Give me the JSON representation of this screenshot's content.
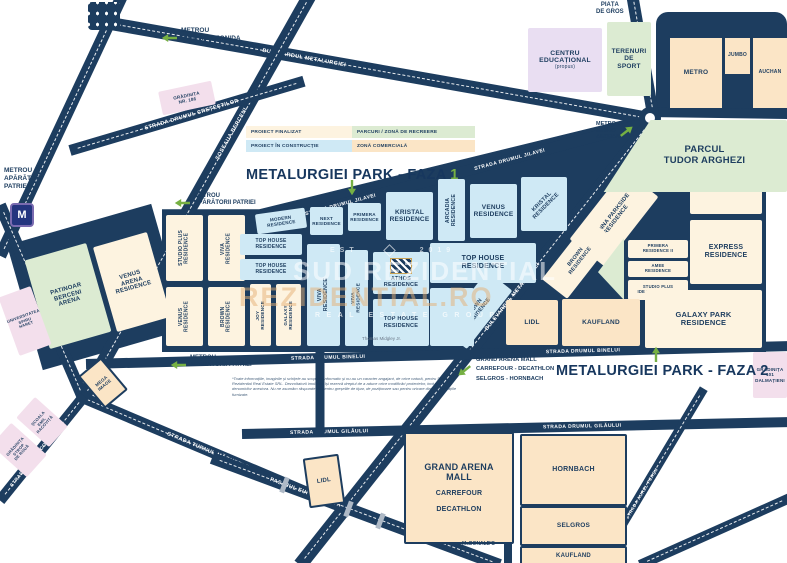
{
  "titles": {
    "faza1_prefix": "METALURGIEI PARK - FAZA ",
    "faza1_number": "1",
    "faza2": "METALURGIEI PARK - FAZA 2"
  },
  "legend": [
    {
      "label": "PROIECT FINALIZAT",
      "color": "#fdf3e0"
    },
    {
      "label": "PROIECT ÎN CONSTRUCȚIE",
      "color": "#cfe9f5"
    },
    {
      "label": "PARCURI / ZONĂ DE RECREERE",
      "color": "#dcebd2"
    },
    {
      "label": "ZONĂ COMERCIALĂ",
      "color": "#fbe5c6"
    }
  ],
  "roads": [
    {
      "label": "BULEVARDUL METALURGIEI"
    },
    {
      "label": "ȘOSEAUA BERCENI"
    },
    {
      "label": "STRADA DRUMUL CREȚEȘTILOR"
    },
    {
      "label": "STRADA DRUMUL JILAVEI",
      "label2": "STRADA DRUMUL JILAVEI"
    },
    {
      "label": "BULEVARDUL METALURGIEI"
    },
    {
      "label": "STRADA DRUMUL BINELUI",
      "label2": "STRADA DRUMUL BINELUI"
    },
    {
      "label": "STRADA DRUMUL GILĂULUI",
      "label2": "STRADA DRUMUL GILĂULUI"
    },
    {
      "label": "STRADA TURNUL MĂGURELE"
    },
    {
      "label": "STRADA EMIL RACOVIȚĂ"
    },
    {
      "label": "PASAJUL EUROPA UNITĂ"
    },
    {
      "label": "STRADA AUREL PERȘU"
    }
  ],
  "blocks": [
    {
      "label": "STUDIO PLUS\nRESIDENCE"
    },
    {
      "label": "VIVA\nRESIDENCE"
    },
    {
      "label": "VENUS\nRESIDENCE"
    },
    {
      "label": "BROWN\nRESIDENCE"
    },
    {
      "label": "JOY\nRESIDENCE"
    },
    {
      "label": "GALAXY\nRESIDENCE"
    },
    {
      "label": "TOP HOUSE\nRESIDENCE"
    },
    {
      "label": "TOP HOUSE\nRESIDENCE"
    },
    {
      "label": "MODERN\nRESIDENCE"
    },
    {
      "label": "NEXT\nRESIDENCE"
    },
    {
      "label": "PRIMERA\nRESIDENCE"
    },
    {
      "label": "KRISTAL\nRESIDENCE"
    },
    {
      "label": "ARCADIA\nRESIDENCE"
    },
    {
      "label": "VENUS\nRESIDENCE"
    },
    {
      "label": "KRISTAL\nRESIDENCE"
    },
    {
      "label": "TOP HOUSE\nRESIDENCE"
    },
    {
      "label": "VIVA\nRESIDENCE"
    },
    {
      "label": "VIVA\nRESIDENCE"
    },
    {
      "label": "ATHOS\nRESIDENCE"
    },
    {
      "label": "TOP HOUSE\nRESIDENCE"
    },
    {
      "label": "BROWN\nRESIDENCE"
    },
    {
      "label": ""
    },
    {
      "label": "VIENNA PARKSIDE\nRESIDENCE"
    },
    {
      "label": ""
    },
    {
      "label": "EXPRESS\nRESIDENCE"
    },
    {
      "label": "PRIMERA\nRESIDENCE II"
    },
    {
      "label": "AMEE\nRESIDENCE"
    },
    {
      "label": "STUDIO PLUS\nIDEAL RESIDENCE"
    },
    {
      "label": ""
    },
    {
      "label": "BROWN\nRESIDENCE"
    },
    {
      "label": "LIDL"
    },
    {
      "label": "KAUFLAND"
    },
    {
      "label": "GALAXY PARK\nRESIDENCE"
    },
    {
      "label": "CENTRU\nEDUCAȚIONAL",
      "sub": "(propus)"
    },
    {
      "label": "TERENURI\nDE\nSPORT"
    },
    {
      "label": "METRO"
    },
    {
      "label": "JUMBO"
    },
    {
      "label": "AUCHAN"
    },
    {
      "label": "PARCUL\nTUDOR ARGHEZI"
    },
    {
      "label": "PATINOAR\nBERCENI\nARENA"
    },
    {
      "label": "VENUS\nARENA\nRESIDENCE"
    },
    {
      "label": "GRĂDINIȚA\nNR. 186"
    },
    {
      "label": "UNIVERSITATEA\nSPIRU\nHARET"
    },
    {
      "label": "ȘCOALA\nEMIL\nRACOVIȚĂ"
    },
    {
      "label": "GRĂDINIȚA\nSTROP\nDE ROUĂ"
    },
    {
      "label": "GRĂDINIȚA\n101\nDALMAȚIENI"
    },
    {
      "label": "MEGA\nIMAGE"
    },
    {
      "label": "GRAND ARENA\nMALL",
      "sub": "CARREFOUR",
      "sub2": "DECATHLON"
    },
    {
      "label": "HORNBACH"
    },
    {
      "label": "SELGROS"
    },
    {
      "label": "KAUFLAND"
    },
    {
      "label": "LIDL"
    }
  ],
  "annotations": {
    "metrou_dimitrie": "METROU\nDIMITRIE LEONIDA",
    "metrou_aparatori_left": "METROU\nAPĂRĂTORI\nPATRIEI",
    "metro_logo": "M",
    "metrou_aparatorii_1": "METROU\nAPĂRĂTORII PATRIEI",
    "metrou_aparatorii_2": "METROU\nAPĂRĂTORII PATRIEI",
    "piata_de_gros": "PIAȚA\nDE GROS",
    "metro_jumbo_auchan": "METRO\nJUMBO\nAUCHAN",
    "grand_arena_pointer": "GRAND ARENA MALL\nCARREFOUR - DECATHLON\nSELGROS - HORNBACH",
    "mcdonalds": "McDONALD'S",
    "small_street": "Thomas Midgley Jr."
  },
  "watermark": {
    "est": "EST",
    "year": "2019",
    "brand_top": "SUD REZIDENTIAL",
    "brand_bottom": "REZIDENTIAL.RO",
    "tagline": "REAL ESTATE GROUP"
  },
  "disclaimer": "*Toate informațiile, imaginile și schițele au scop pur informativ și nu au un caracter angajant, de orice natură, pentru Sud Rezidential Real Estate SRL. Dezvoltatorii imobiliari își rezervă dreptul de a aduce orice modificări proiectelor, inclusiv a denumirilor acestora. Nu ne asumăm răspunderea pentru greșelile de tipar, de poziționare sau pentru oricare dintre informațiile furnizate.",
  "colors": {
    "road_navy": "#1d3d5f",
    "accent_green": "#76b043",
    "finalized": "#fdf3e0",
    "in_construction": "#cfe9f5",
    "recreation": "#dcebd2",
    "commercial": "#fbe5c6",
    "school_pink": "#f3dfec",
    "proposed_purple": "#e9def2"
  }
}
